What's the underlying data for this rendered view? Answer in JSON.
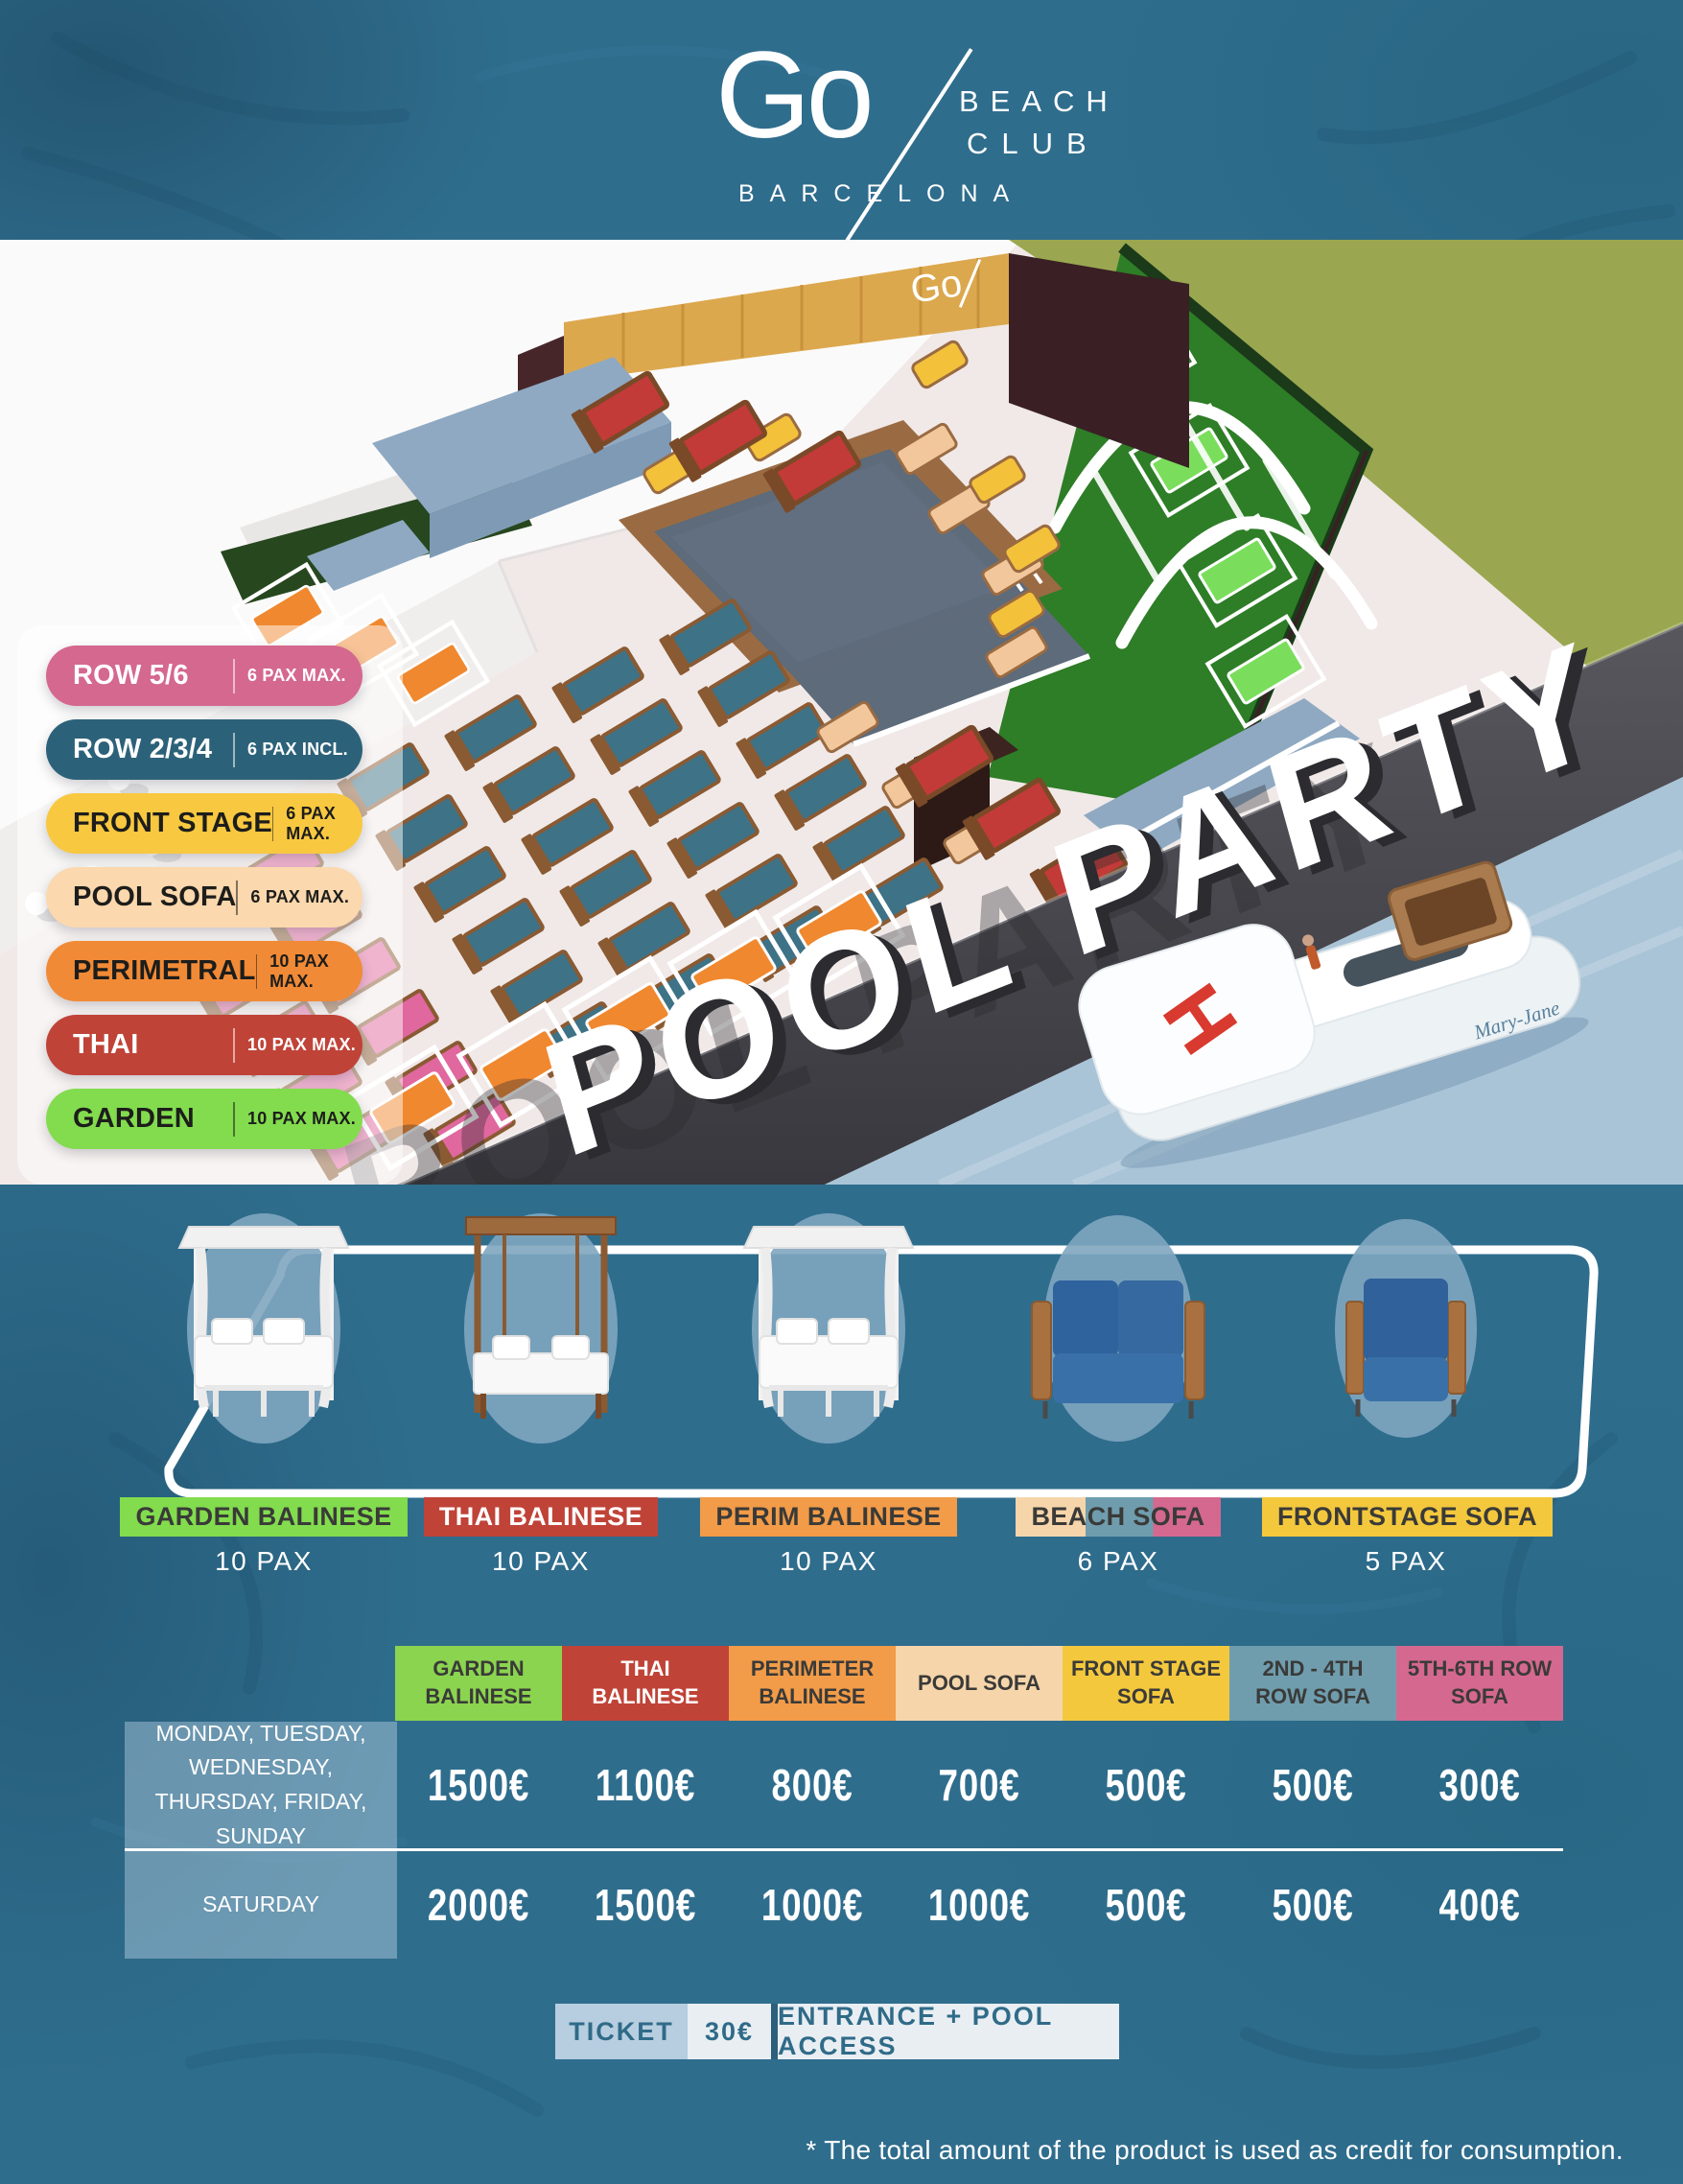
{
  "header": {
    "logo_main": "Go",
    "logo_line1": "BEACH",
    "logo_line2": "CLUB",
    "logo_city": "BARCELONA",
    "schedule": "EVERY DAY 17:30 - 23:00"
  },
  "map": {
    "legend": [
      {
        "label": "ROW 5/6",
        "pax": "6 PAX MAX.",
        "bg": "#d5688f",
        "text": "#ffffff"
      },
      {
        "label": "ROW 2/3/4",
        "pax": "6 PAX INCL.",
        "bg": "#2c6279",
        "text": "#ffffff"
      },
      {
        "label": "FRONT STAGE",
        "pax": "6 PAX MAX.",
        "bg": "#f8c840",
        "text": "#1d1d1b"
      },
      {
        "label": "POOL SOFA",
        "pax": "6 PAX MAX.",
        "bg": "#fbd8ad",
        "text": "#1d1d1b"
      },
      {
        "label": "PERIMETRAL",
        "pax": "10 PAX MAX.",
        "bg": "#f18a36",
        "text": "#1d1d1b"
      },
      {
        "label": "THAI",
        "pax": "10 PAX MAX.",
        "bg": "#c04338",
        "text": "#ffffff"
      },
      {
        "label": "GARDEN",
        "pax": "10 PAX MAX.",
        "bg": "#82dc4e",
        "text": "#1d1d1b"
      }
    ],
    "sign": "POOL PARTY",
    "wall_logo": "Go",
    "helipad_letter": "H",
    "boat_name": "Mary-Jane"
  },
  "furniture": [
    {
      "name": "GARDEN BALINESE",
      "pax": "10 PAX",
      "chip_bg": "#82dc4e",
      "chip_text": "#3a3a38"
    },
    {
      "name": "THAI BALINESE",
      "pax": "10 PAX",
      "chip_bg": "#c04338",
      "chip_text": "#ffffff"
    },
    {
      "name": "PERIM BALINESE",
      "pax": "10 PAX",
      "chip_bg": "#f29b48",
      "chip_text": "#3a3a38"
    },
    {
      "name": "BEACH SOFA",
      "pax": "6 PAX",
      "chip_bg": "linear-gradient(90deg,#f6d5ab 0 34%,#6f9dae 34% 67%,#d5688f 67% 100%)",
      "chip_text": "#3a3a38"
    },
    {
      "name": "FRONTSTAGE SOFA",
      "pax": "5 PAX",
      "chip_bg": "#f4c83d",
      "chip_text": "#3a3a38"
    }
  ],
  "pricing": {
    "columns": [
      {
        "label": "GARDEN BALINESE",
        "bg": "#8bd44f",
        "text": "#3a3a38"
      },
      {
        "label": "THAI BALINESE",
        "bg": "#c04338",
        "text": "#ffffff"
      },
      {
        "label": "PERIMETER BALINESE",
        "bg": "#f29b48",
        "text": "#3a3a38"
      },
      {
        "label": "POOL SOFA",
        "bg": "#f6d5ab",
        "text": "#3a3a38"
      },
      {
        "label": "FRONT STAGE SOFA",
        "bg": "#f4c83d",
        "text": "#3a3a38"
      },
      {
        "label": "2ND - 4TH ROW SOFA",
        "bg": "#6f9dae",
        "text": "#3a3a38"
      },
      {
        "label": "5TH-6TH ROW SOFA",
        "bg": "#d5688f",
        "text": "#3a3a38"
      }
    ],
    "rows": [
      {
        "day": "MONDAY, TUESDAY, WEDNESDAY, THURSDAY, FRIDAY, SUNDAY",
        "prices": [
          "1500€",
          "1100€",
          "800€",
          "700€",
          "500€",
          "500€",
          "300€"
        ]
      },
      {
        "day": "SATURDAY",
        "prices": [
          "2000€",
          "1500€",
          "1000€",
          "1000€",
          "500€",
          "500€",
          "400€"
        ]
      }
    ]
  },
  "ticket": {
    "label": "TICKET",
    "price": "30€",
    "description": "ENTRANCE + POOL ACCESS",
    "label_bg": "#b7cde0",
    "light_bg": "#e9eef3",
    "divider_color": "#2c5f7b",
    "text_color": "#2f6b88"
  },
  "footnote": "* The total amount of the product is used as credit for consumption."
}
